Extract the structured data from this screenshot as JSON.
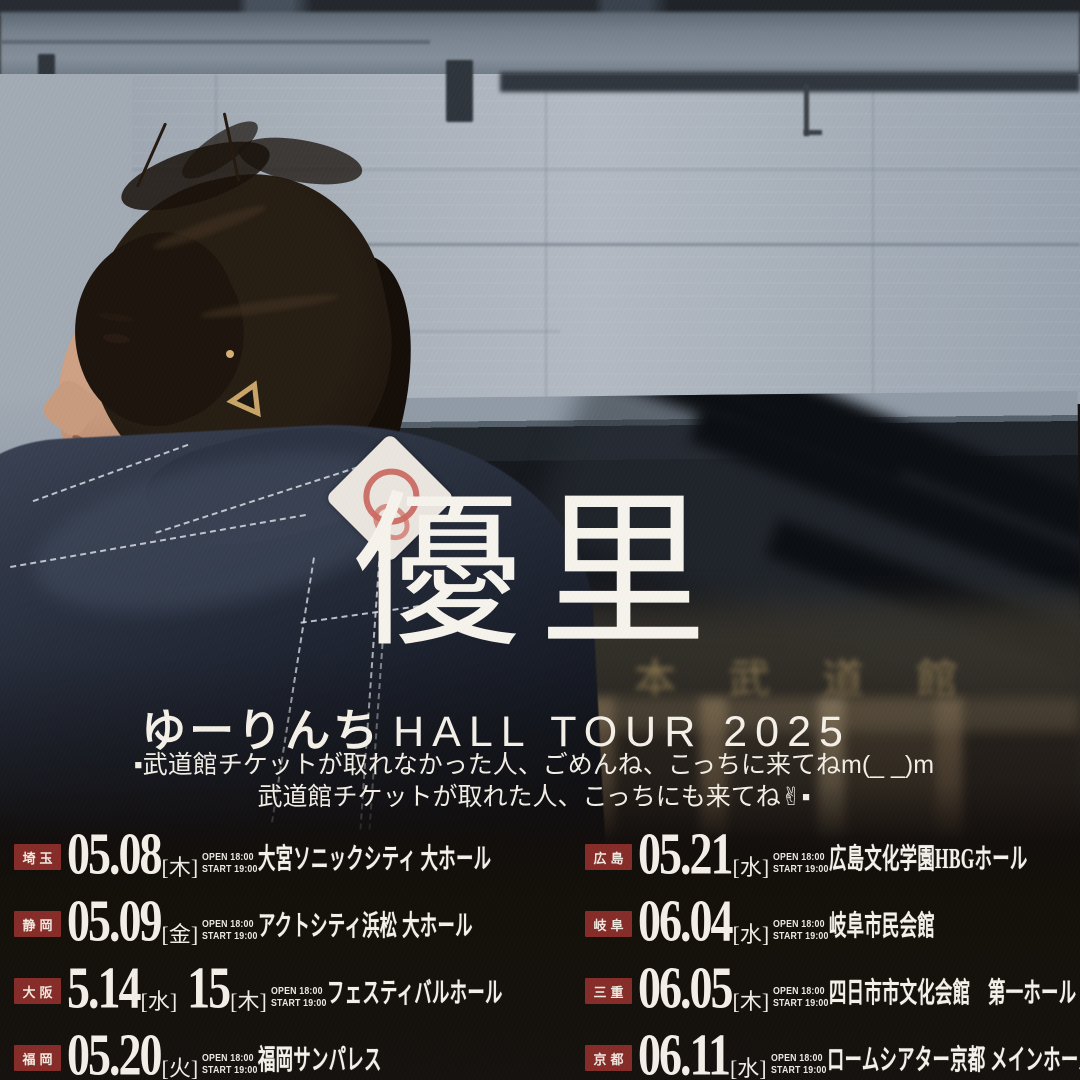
{
  "poster": {
    "title": "優 里",
    "subtitle_ja": "ゆーりんち",
    "subtitle_en": "HALL TOUR 2025",
    "message_line1": "▪武道館チケットが取れなかった人、ごめんね、こっちに来てねm(_ _)m",
    "message_line2": "武道館チケットが取れた人、こっちにも来てね✌▪",
    "building_sign": "日本武道館"
  },
  "colors": {
    "accent_red": "#862c29",
    "text_white": "#f4f1ea",
    "gold_sign": "#ad935f",
    "denim": "#232a38",
    "wall": "#a9b1bb",
    "dark_bg": "#15110e"
  },
  "dates": {
    "rows": [
      {
        "pref": "埼玉",
        "d1": "05.08",
        "day1": "[木]",
        "d2": "",
        "day2": "",
        "open": "OPEN 18:00",
        "start": "START 19:00",
        "venue": "大宮ソニックシティ 大ホール"
      },
      {
        "pref": "静岡",
        "d1": "05.09",
        "day1": "[金]",
        "d2": "",
        "day2": "",
        "open": "OPEN 18:00",
        "start": "START 19:00",
        "venue": "アクトシティ浜松 大ホール"
      },
      {
        "pref": "大阪",
        "d1": "5.14",
        "day1": "[水]",
        "d2": "15",
        "day2": "[木]",
        "open": "OPEN 18:00",
        "start": "START 19:00",
        "venue": "フェスティバルホール"
      },
      {
        "pref": "福岡",
        "d1": "05.20",
        "day1": "[火]",
        "d2": "",
        "day2": "",
        "open": "OPEN 18:00",
        "start": "START 19:00",
        "venue": "福岡サンパレス"
      },
      {
        "pref": "広島",
        "d1": "05.21",
        "day1": "[水]",
        "d2": "",
        "day2": "",
        "open": "OPEN 18:00",
        "start": "START 19:00",
        "venue": "広島文化学園HBGホール"
      },
      {
        "pref": "岐阜",
        "d1": "06.04",
        "day1": "[水]",
        "d2": "",
        "day2": "",
        "open": "OPEN 18:00",
        "start": "START 19:00",
        "venue": "岐阜市民会館"
      },
      {
        "pref": "三重",
        "d1": "06.05",
        "day1": "[木]",
        "d2": "",
        "day2": "",
        "open": "OPEN 18:00",
        "start": "START 19:00",
        "venue": "四日市市文化会館　第一ホール"
      },
      {
        "pref": "京都",
        "d1": "06.11",
        "day1": "[水]",
        "d2": "",
        "day2": "",
        "open": "OPEN 18:00",
        "start": "START 19:00",
        "venue": "ロームシアター京都 メインホール"
      }
    ]
  }
}
